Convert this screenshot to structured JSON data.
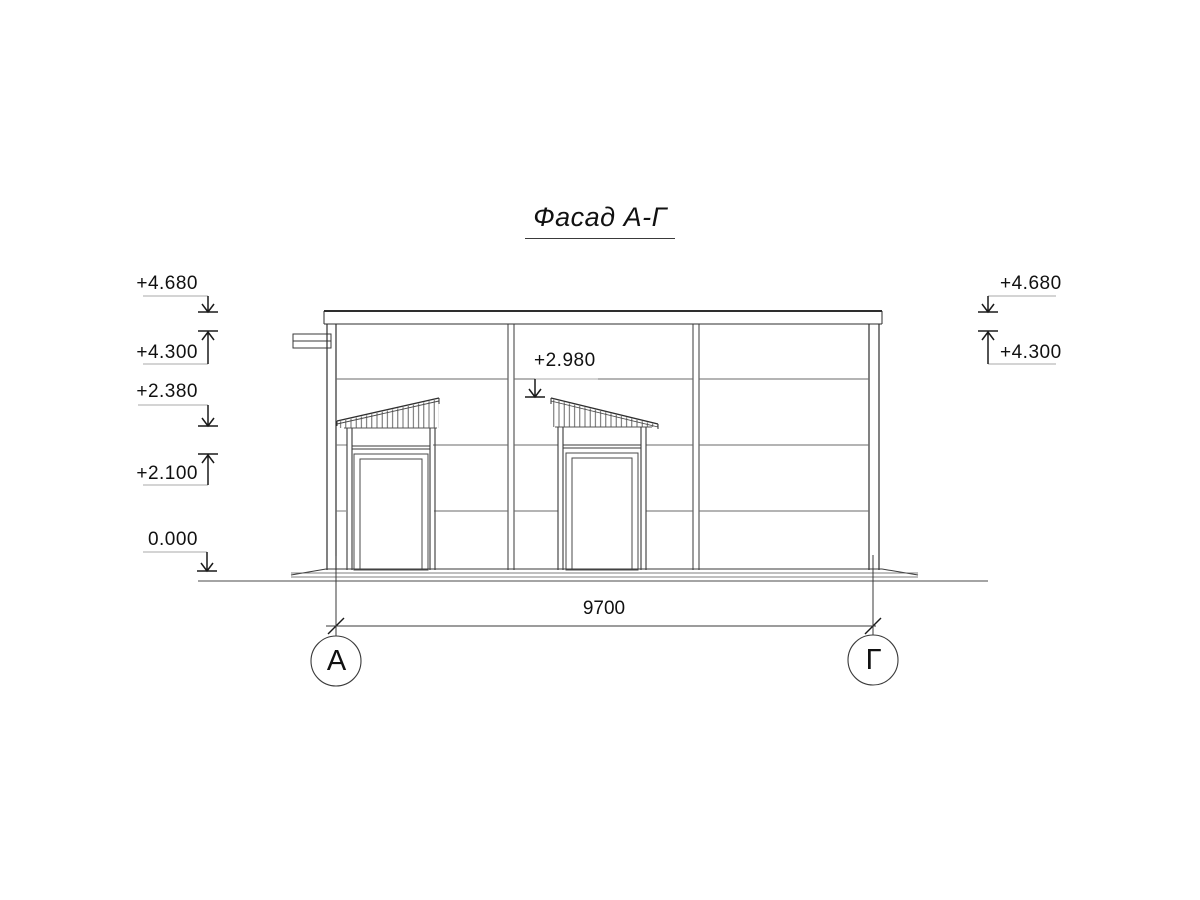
{
  "title": "Фасад А-Г",
  "elevation_marks": {
    "left": [
      "+4.680",
      "+4.300",
      "+2.380",
      "+2.100",
      "0.000"
    ],
    "right": [
      "+4.680",
      "+4.300"
    ],
    "canopy": "+2.980"
  },
  "dimension": {
    "overall_width": "9700"
  },
  "axes": {
    "left": "А",
    "right": "Г"
  },
  "colors": {
    "background": "#ffffff",
    "outline": "#2e2e2e",
    "secondary_line": "#4a4a4a",
    "panel_joint": "#6a6a6a",
    "leader": "#a8a8a8",
    "text": "#111111"
  }
}
